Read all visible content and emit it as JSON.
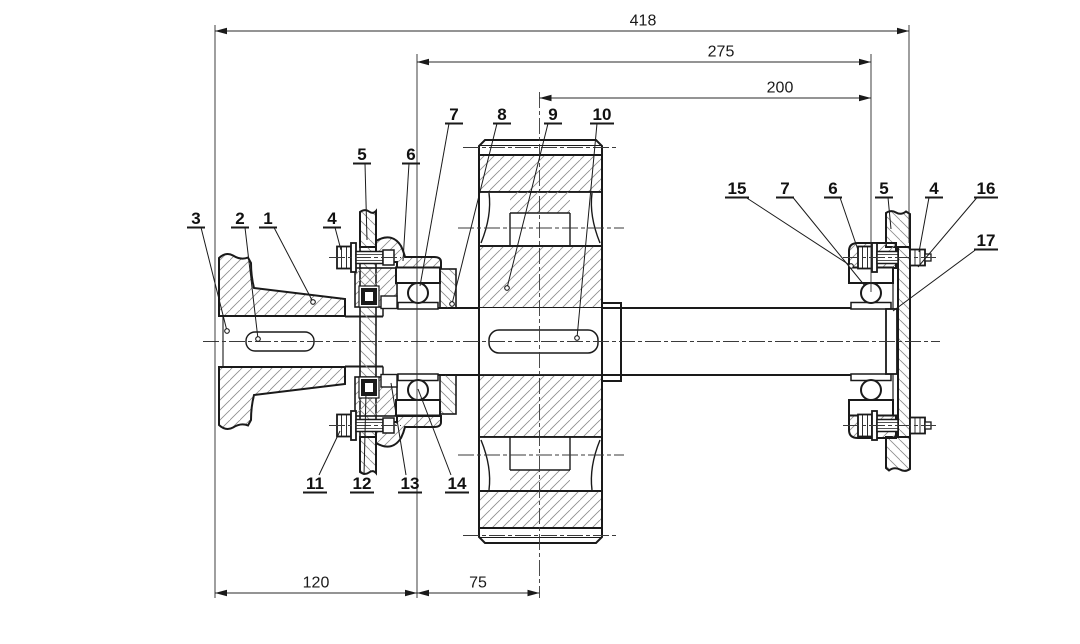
{
  "drawing": {
    "background": "#ffffff",
    "line_color": "#1a1a1a",
    "hatch_color": "#8c8c8c",
    "dimensions": [
      {
        "id": "dim-overall-length",
        "label": "418"
      },
      {
        "id": "dim-bearing-span",
        "label": "275"
      },
      {
        "id": "dim-gear-center-to-right-bearing",
        "label": "200"
      },
      {
        "id": "dim-hub-face-to-left-bearing",
        "label": "120"
      },
      {
        "id": "dim-left-bearing-to-gear-center",
        "label": "75"
      }
    ],
    "callouts": [
      {
        "id": "callout-3",
        "label": "3"
      },
      {
        "id": "callout-2",
        "label": "2"
      },
      {
        "id": "callout-1",
        "label": "1"
      },
      {
        "id": "callout-4-left",
        "label": "4"
      },
      {
        "id": "callout-5-left",
        "label": "5"
      },
      {
        "id": "callout-6-left",
        "label": "6"
      },
      {
        "id": "callout-7-left",
        "label": "7"
      },
      {
        "id": "callout-8",
        "label": "8"
      },
      {
        "id": "callout-9",
        "label": "9"
      },
      {
        "id": "callout-10",
        "label": "10"
      },
      {
        "id": "callout-11",
        "label": "11"
      },
      {
        "id": "callout-12",
        "label": "12"
      },
      {
        "id": "callout-13",
        "label": "13"
      },
      {
        "id": "callout-14",
        "label": "14"
      },
      {
        "id": "callout-15",
        "label": "15"
      },
      {
        "id": "callout-7-right",
        "label": "7"
      },
      {
        "id": "callout-6-right",
        "label": "6"
      },
      {
        "id": "callout-5-right",
        "label": "5"
      },
      {
        "id": "callout-4-right",
        "label": "4"
      },
      {
        "id": "callout-16",
        "label": "16"
      },
      {
        "id": "callout-17",
        "label": "17"
      }
    ]
  }
}
